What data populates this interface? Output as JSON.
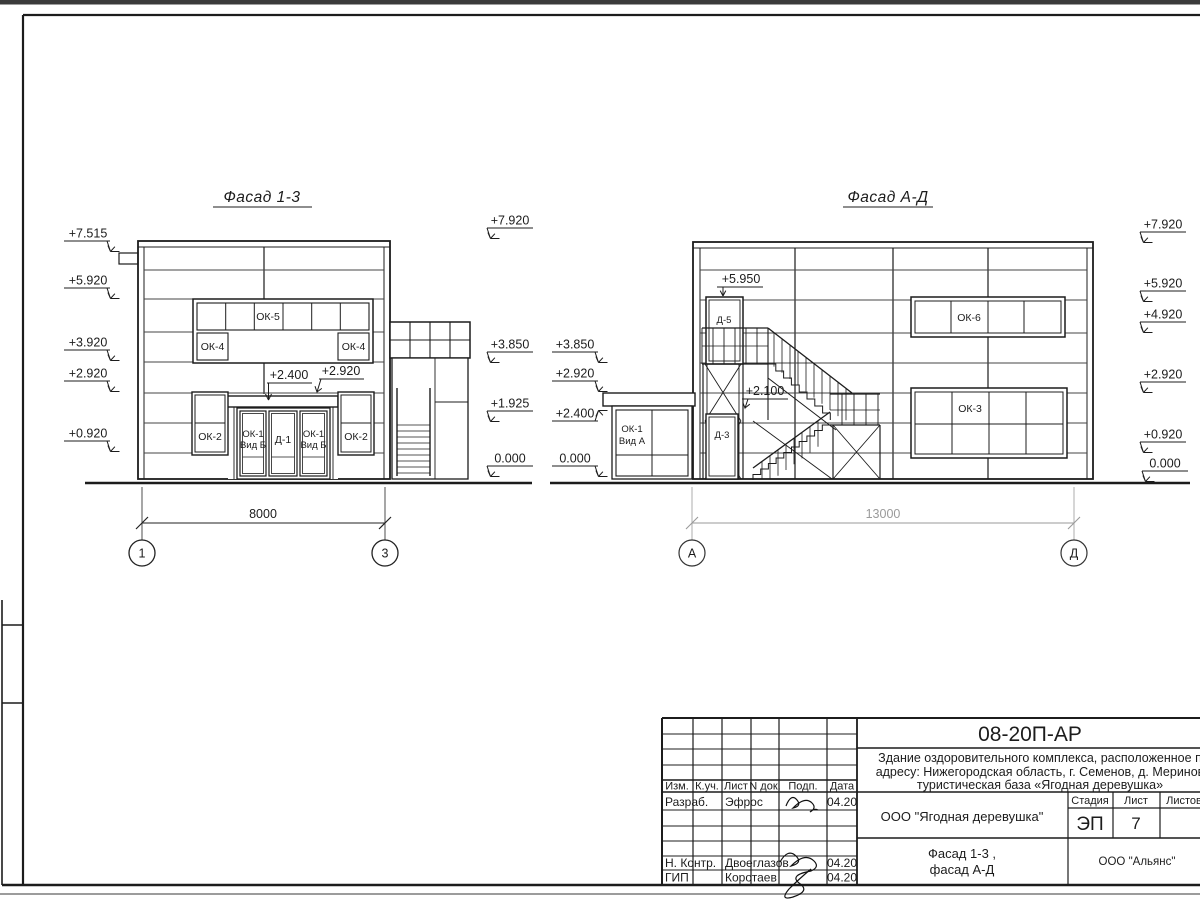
{
  "facade13": {
    "title": "Фасад 1-3",
    "marks_left": [
      "+7.515",
      "+5.920",
      "+3.920",
      "+2.920",
      "+0.920"
    ],
    "marks_right": [
      "+7.920",
      "+3.850",
      "+1.925",
      "0.000"
    ],
    "ann_2400": "+2.400",
    "ann_2920": "+2.920",
    "ok5": "ОК-5",
    "ok4_left": "ОК-4",
    "ok4_right": "ОК-4",
    "ok2_left": "ОК-2",
    "ok2_right": "ОК-2",
    "ok1_left_1": "ОК-1",
    "ok1_left_2": "Вид Б",
    "d1": "Д-1",
    "ok1_right_1": "ОК-1",
    "ok1_right_2": "Вид Б",
    "dim": "8000",
    "axis_1": "1",
    "axis_3": "3"
  },
  "facadeAD": {
    "title": "Фасад А-Д",
    "marks_left": [
      "+3.850",
      "+2.920",
      "+2.400",
      "0.000"
    ],
    "marks_right": [
      "+7.920",
      "+5.920",
      "+4.920",
      "+2.920",
      "+0.920",
      "0.000"
    ],
    "ann_5950": "+5.950",
    "ann_2100": "+2.100",
    "ok6": "ОК-6",
    "ok3": "ОК-3",
    "ok1_1": "ОК-1",
    "ok1_2": "Вид А",
    "d5": "Д-5",
    "d3": "Д-3",
    "dim": "13000",
    "axis_a": "А",
    "axis_d": "Д"
  },
  "title_block": {
    "code": "08-20П-АР",
    "desc1": "Здание оздоровительного комплекса, расположенное п",
    "desc2": "адресу: Нижегородская область, г. Семенов, д. Меринов",
    "desc3": "туристическая база «Ягодная деревушка»",
    "cols": [
      "Изм.",
      "К.уч.",
      "Лист",
      "N док.",
      "Подп.",
      "Дата"
    ],
    "rows": [
      {
        "role": "Разраб.",
        "name": "Эфрос",
        "date": "04.20"
      },
      {
        "role": "Н. Контр.",
        "name": "Двоеглазов",
        "date": "04.20"
      },
      {
        "role": "ГИП",
        "name": "Коротаев",
        "date": "04.20"
      }
    ],
    "client": "ООО \"Ягодная деревушка\"",
    "stage_label": "Стадия",
    "sheet_label": "Лист",
    "sheets_label": "Листов",
    "stage": "ЭП",
    "sheet": "7",
    "doc_title1": "Фасад 1-3 ,",
    "doc_title2": "фасад А-Д",
    "org": "ООО \"Альянс\""
  }
}
